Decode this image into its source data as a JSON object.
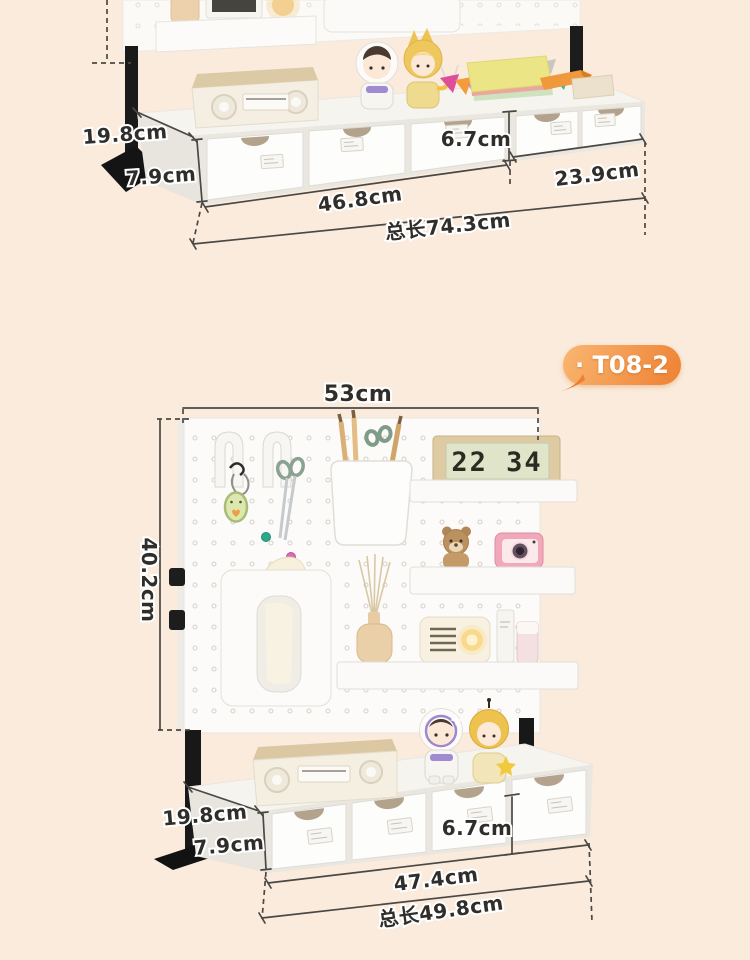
{
  "page": {
    "background_color": "#FAEBDC",
    "accent_color": "#EE8133",
    "annotation_text_color": "#2F2E2B"
  },
  "badge": {
    "label": "· T08-2"
  },
  "figure_top": {
    "dims": {
      "depth": "19.8cm",
      "base_height": "7.9cm",
      "drawer_height": "6.7cm",
      "module_left": "46.8cm",
      "module_right": "23.9cm",
      "total": "总长74.3cm"
    }
  },
  "figure_bottom": {
    "dims": {
      "width": "53cm",
      "height": "40.2cm",
      "depth": "19.8cm",
      "base_height": "7.9cm",
      "drawer_height": "6.7cm",
      "row": "47.4cm",
      "total": "总长49.8cm"
    },
    "clock_time": "22 34"
  }
}
